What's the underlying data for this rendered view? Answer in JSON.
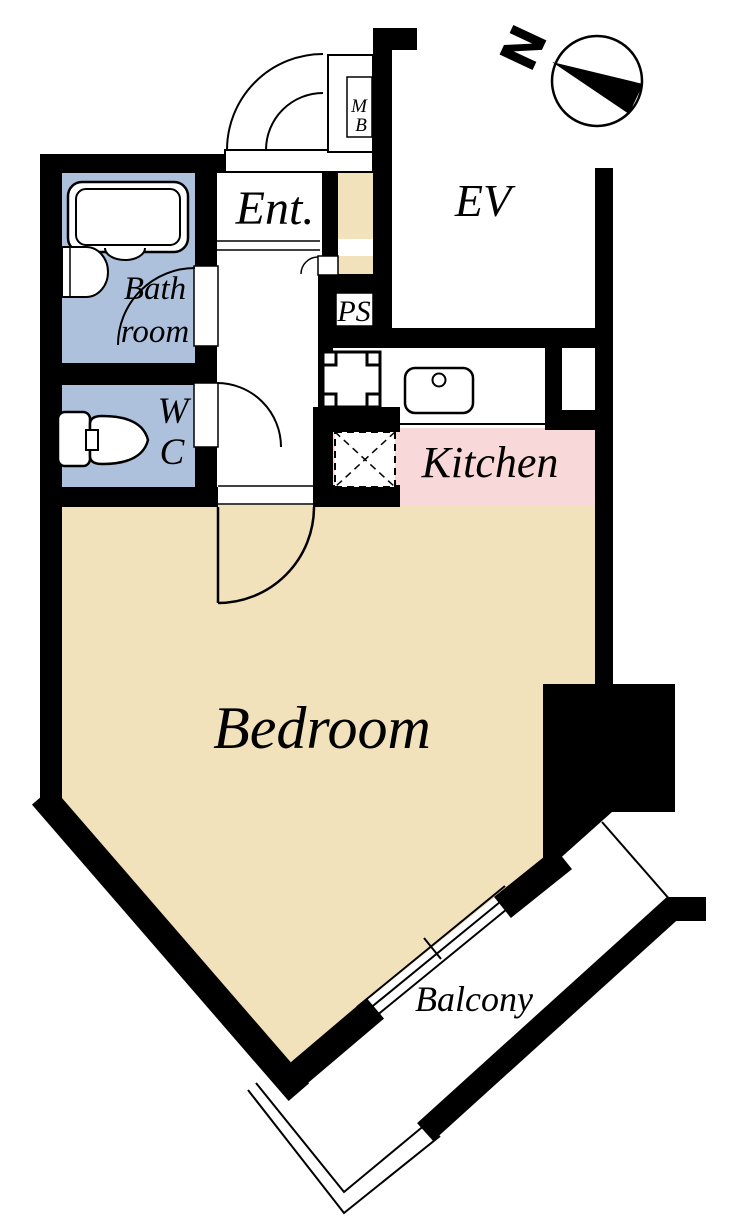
{
  "plan": {
    "labels": {
      "entrance": "Ent.",
      "elevator": "EV",
      "meter_box_line1": "M",
      "meter_box_line2": "B",
      "pipe_space": "PS",
      "bathroom_line1": "Bath",
      "bathroom_line2": "room",
      "wc_line1": "W",
      "wc_line2": "C",
      "kitchen": "Kitchen",
      "bedroom": "Bedroom",
      "balcony": "Balcony",
      "compass_north": "N"
    },
    "colors": {
      "wall": "#000000",
      "line": "#000000",
      "background": "#ffffff",
      "flooring": "#f2e2bc",
      "kitchen_floor": "#f8d8d8",
      "wet_area_floor": "#aec1dc"
    }
  }
}
